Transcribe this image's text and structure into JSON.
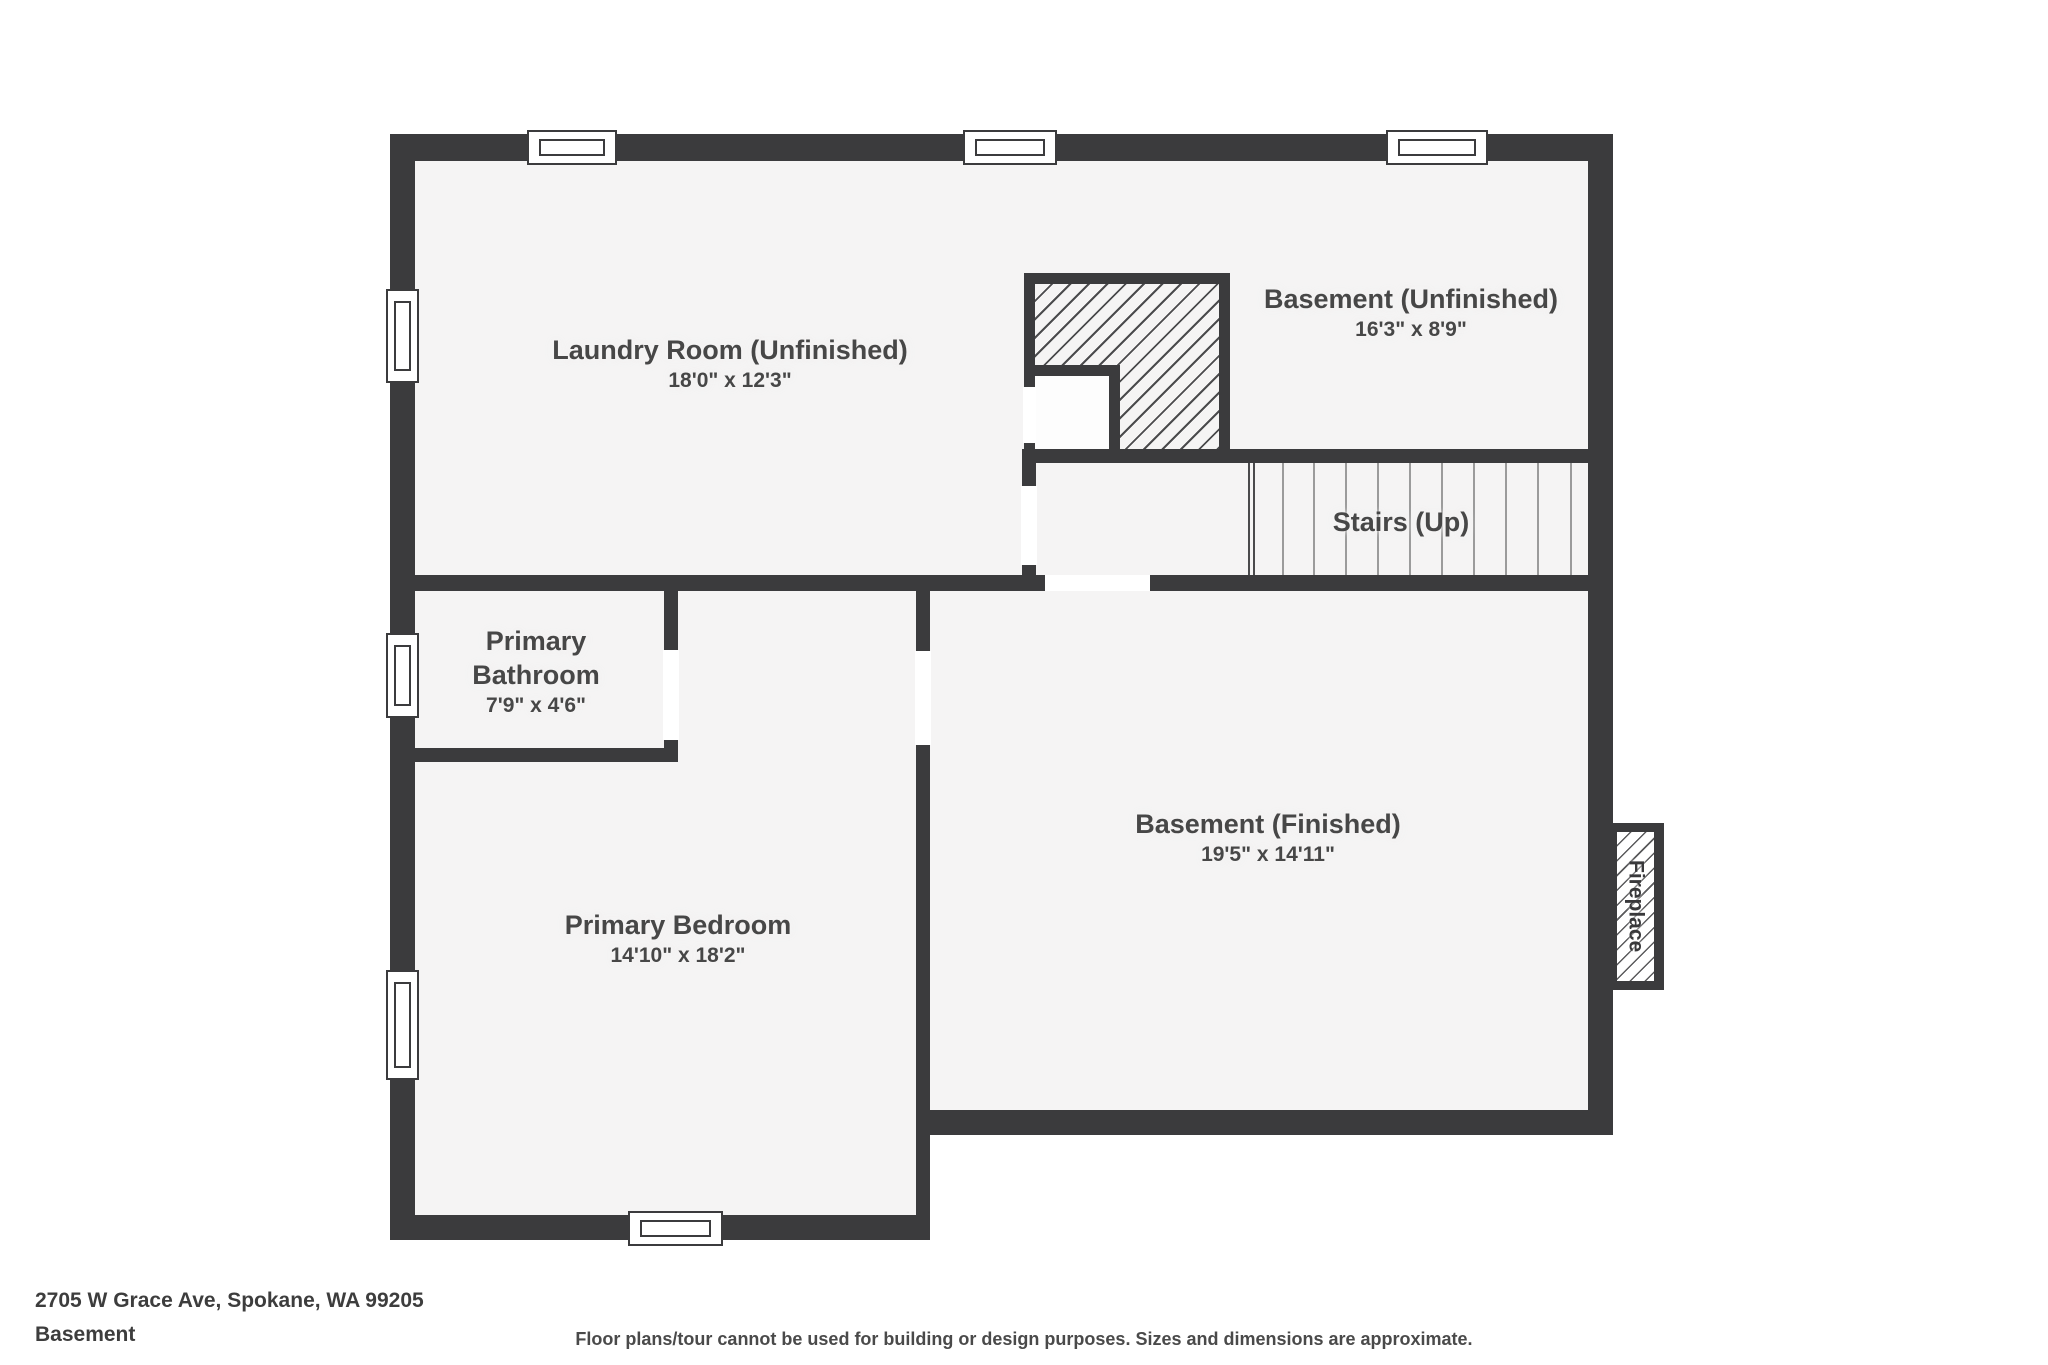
{
  "colors": {
    "wall": "#3b3b3d",
    "floor": "#f5f4f4",
    "label": "#474747",
    "tread": "#9b9b9b",
    "hatch": "#4b4b4d",
    "footer": "#3d3d3d"
  },
  "rooms": {
    "laundry": {
      "name": "Laundry Room (Unfinished)",
      "dims": "18'0\" x 12'3\""
    },
    "basement_unfinished": {
      "name": "Basement (Unfinished)",
      "dims": "16'3\" x 8'9\""
    },
    "stairs": {
      "name": "Stairs (Up)"
    },
    "bathroom": {
      "name_line1": "Primary",
      "name_line2": "Bathroom",
      "dims": "7'9\" x 4'6\""
    },
    "bedroom": {
      "name": "Primary Bedroom",
      "dims": "14'10\" x 18'2\""
    },
    "basement_finished": {
      "name": "Basement (Finished)",
      "dims": "19'5\" x 14'11\""
    },
    "fireplace": {
      "name": "Fireplace"
    }
  },
  "footer": {
    "address": "2705 W Grace Ave, Spokane, WA 99205",
    "level": "Basement",
    "disclaimer": "Floor plans/tour cannot be used for building or design purposes. Sizes and dimensions are approximate."
  }
}
